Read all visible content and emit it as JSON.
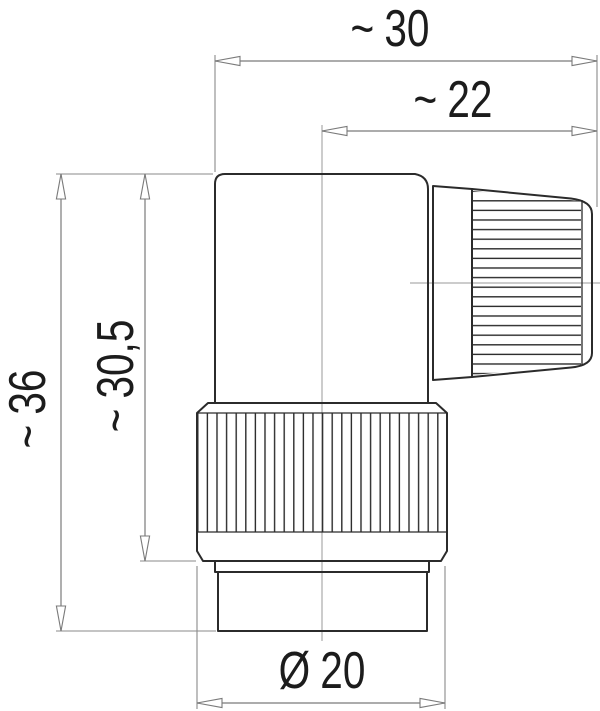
{
  "drawing": {
    "type": "technical-dimension-drawing",
    "view": "side view of right-angle circular connector",
    "colors": {
      "outline": "#2b2b2b",
      "dimension_lines": "#7a7a7a",
      "label_text": "#1c1c1c",
      "background": "#ffffff"
    },
    "dimensions": {
      "overall_width": {
        "approx": "~",
        "value": "30"
      },
      "cable_gland_width": {
        "approx": "~",
        "value": "22"
      },
      "overall_height": {
        "approx": "~",
        "value": "36"
      },
      "body_height": {
        "approx": "~",
        "value": "30,5"
      },
      "coupling_ring_diameter": {
        "symbol": "Ø",
        "value": "20"
      }
    }
  }
}
